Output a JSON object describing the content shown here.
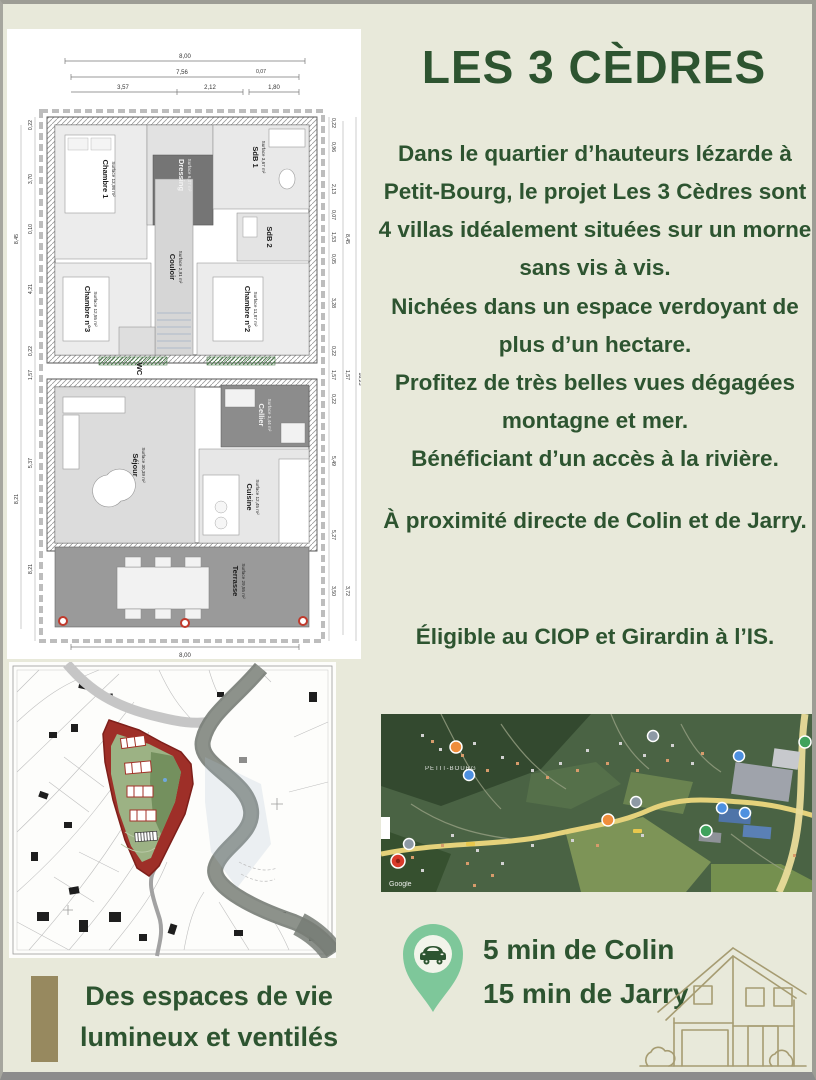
{
  "palette": {
    "background": "#e8e9da",
    "accent_green": "#2d5430",
    "pin_green": "#7ec79a",
    "olive_bar": "#97895f",
    "house_line": "#a69c72",
    "site_red": "#9e2f28",
    "site_green": "#9cb284"
  },
  "header": {
    "title": "LES 3 CÈDRES"
  },
  "paragraphs": [
    "Dans le quartier d’hauteurs lézarde à Petit-Bourg, le projet Les 3 Cèdres sont 4 villas idéalement situées sur un morne sans vis à vis.",
    "Nichées dans un espace verdoyant de plus d’un hectare.\nProfitez de très belles vues dégagées montagne et mer.",
    "Bénéficiant d’un accès à la rivière.",
    "À proximité directe de Colin et de Jarry.",
    "Éligible au CIOP et Girardin à l’IS."
  ],
  "transport": {
    "line1": "5 min de Colin",
    "line2": "15 min de Jarry",
    "icon": "car-location-pin"
  },
  "tagline": {
    "line1": "Des espaces de vie",
    "line2": "lumineux et ventilés"
  },
  "satellite": {
    "place_label": "PETIT-BOURG",
    "attribution": "Google"
  },
  "floor_plan": {
    "rooms": [
      {
        "name": "Chambre 1",
        "area": "Surface 13,98 m²"
      },
      {
        "name": "Dressing",
        "area": "Surface 6,07 m²"
      },
      {
        "name": "SdB 1",
        "area": "Surface 3,67 m²"
      },
      {
        "name": "SdB 2",
        "area": "Surface 5,03 m²"
      },
      {
        "name": "Couloir",
        "area": "Surface 2,91 m²"
      },
      {
        "name": "Chambre n°3",
        "area": "Surface 12,55 m²"
      },
      {
        "name": "Chambre n°2",
        "area": "Surface 11,87 m²"
      },
      {
        "name": "WC",
        "area": "Surface 1,51 m²"
      },
      {
        "name": "Cellier",
        "area": "Surface 3,44 m²"
      },
      {
        "name": "Séjour",
        "area": "Surface 30,39 m²"
      },
      {
        "name": "Cuisine",
        "area": "Surface 12,45 m²"
      },
      {
        "name": "Terrasse",
        "area": "Surface 29,55 m²"
      }
    ],
    "dims": {
      "top": [
        "8,00",
        "7,56",
        "0,07",
        "3,57",
        "2,12",
        "1,80"
      ],
      "bottom": "8,00",
      "left": [
        "0,22",
        "3,70",
        "0,10",
        "4,21",
        "0,22",
        "1,57",
        "5,37",
        "8,21"
      ],
      "left_outer": [
        "8,45",
        "8,21"
      ],
      "right": [
        "0,22",
        "0,96",
        "2,13",
        "0,07",
        "1,53",
        "0,05",
        "3,28",
        "0,22",
        "1,57",
        "0,22",
        "5,49",
        "5,27",
        "3,50"
      ],
      "right_outer": [
        "8,45",
        "1,57",
        "3,72"
      ],
      "overall": "18,23"
    }
  }
}
